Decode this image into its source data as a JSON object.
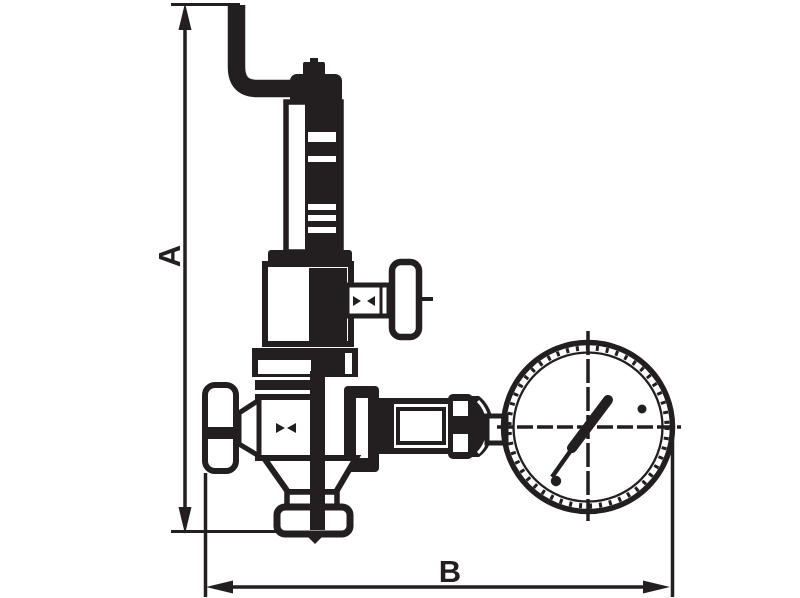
{
  "canvas": {
    "width": 800,
    "height": 598,
    "background": "#ffffff"
  },
  "drawing": {
    "kind": "technical-line-drawing",
    "subject": "safety relief valve with elbow discharge pipe, side handwheels and pressure gauge",
    "line_color": "#231f20",
    "dimension_labels": {
      "vertical": "A",
      "horizontal": "B"
    },
    "gauge": {
      "dial_style": "crosshair centerlines with dashed graduation ring",
      "needle_points": "upper-right (about 54 degrees above horizontal)"
    },
    "components": [
      "dimension-line-a",
      "dimension-line-b",
      "relief-discharge-pipe",
      "bonnet-cap",
      "spring-bonnet-tube",
      "adjusting-screw",
      "bonnet-flange",
      "spring-chamber",
      "outlet-stem",
      "outlet-t-handle",
      "inlet-handwheel",
      "valve-body",
      "drain-funnel",
      "bottom-outlet-flange",
      "gauge-nipple",
      "gauge-union-nut",
      "gauge-bell-connector",
      "pressure-gauge",
      "gauge-needle"
    ]
  }
}
